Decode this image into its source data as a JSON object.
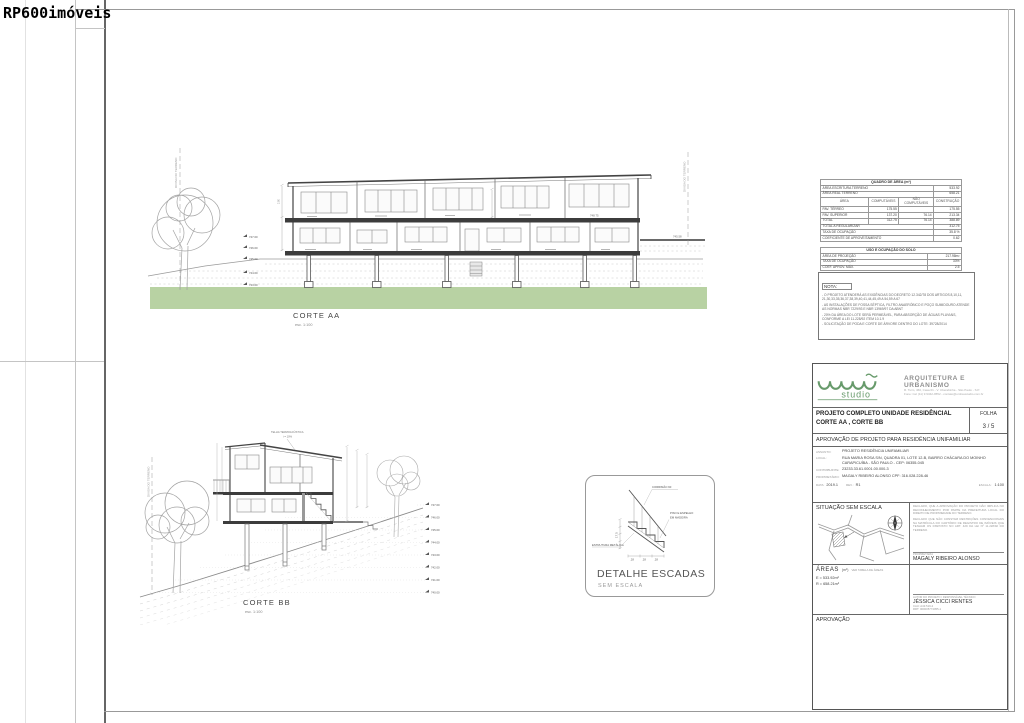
{
  "watermark": "RP600imóveis",
  "colors": {
    "grass": "#b8d2a3",
    "logo_green": "#679a6b",
    "slab_dark": "#3c3c3c"
  },
  "corte_aa": {
    "label": "CORTE AA",
    "scale": "esc. 1:100",
    "divisa": "DIVISA DO TERRENO",
    "levels": [
      "747.00",
      "746.00",
      "745.00",
      "744.00",
      "743.00"
    ],
    "level_upper": "748.75",
    "level_terrace": "745.58",
    "dim_floor": "2.80"
  },
  "corte_bb": {
    "label": "CORTE BB",
    "scale": "esc. 1:100",
    "divisa": "DIVISA DO TERRENO",
    "roof_note_1": "TELHA TERMOACÚSTICA",
    "roof_note_2": "i = 10%",
    "levels": [
      "747.00",
      "746.00",
      "745.00",
      "744.00",
      "743.00",
      "742.00",
      "741.00",
      "740.00"
    ]
  },
  "detalhe": {
    "title": "DETALHE ESCADAS",
    "subtitle": "SEM ESCALA",
    "handrail": "CORRIMÃO 90",
    "wood_1": "PISO E ESPELHO",
    "wood_2": "EM MADEIRA",
    "metal": "ESTRUTURA METÁLICA",
    "riser": "17.5",
    "treads": [
      ".28",
      ".28",
      ".28"
    ]
  },
  "quadro_area": {
    "title": "QUADRO DE ÁREA (m²)",
    "rows_top": [
      [
        "ÁREA ESCRITURA TERRENO",
        "533.92"
      ],
      [
        "ÁREA REAL TERRENO",
        "658.21"
      ]
    ],
    "header": [
      "ÁREA",
      "COMPUTÁVEIS",
      "NÃO COMPUTÁVEIS",
      "CONSTRUÇÃO"
    ],
    "rows": [
      [
        "PAV. TÉRREO",
        "175.55",
        "",
        "175.55"
      ],
      [
        "PAV. SUPERIOR",
        "137.20",
        "76.14",
        "213.34"
      ],
      [
        "TOTAL",
        "312.75",
        "76.14",
        "388.89"
      ]
    ],
    "rows_bottom": [
      [
        "TOTAL A REGULARIZAR",
        "312.75"
      ],
      [
        "TAXA DE OCUPAÇÃO",
        "35.8 %"
      ],
      [
        "COEFICIENTE DE APROVEITAMENTO",
        "0.62"
      ]
    ]
  },
  "uso_solo": {
    "title": "USO E OCUPAÇÃO DO SOLO",
    "rows": [
      [
        "ÁREA DE PROJEÇÃO",
        "217.98m²"
      ],
      [
        "TAXA DE OCUPAÇÃO",
        "33%"
      ],
      [
        "COEF. APROV. MÁX.",
        "2.5"
      ]
    ]
  },
  "nota": {
    "title": "NOTA:",
    "items": [
      "- O PROJETO ATENDERÁ AS EXIGÊNCIAS DO DECRETO 12.342/78 DOS ARTIGOS 8,10,11, 21,30,33,35,36,37,38,39,40,41,44,45,49 A 54,59 A 67",
      "- AS INSTALAÇÕES DE FOSSA SÉPTICA, FILTRO ANAERÓBICO E POÇO SUMIDOURO ATENDE AS NORMAS NBR 7229/93 E NBR 13969/97 DA ABNT",
      "- 20% DA ÁREA DO LOTE SERÁ PERMEÁVEL, PARA ABSORÇÃO DE ÁGUAS PLUVIAIS, CONFORME A LEI 11.228/92 ITEM 10.1.9",
      "- SOLICITAÇÃO DE PODA E CORTE DE ÁRVORE DENTRO DO LOTE: 39728/2014"
    ]
  },
  "titleblock": {
    "logo_name": "studio",
    "arch_title": "ARQUITETURA E URBANISMO",
    "addr1": "R. Tuim, 460, Casa 01 - V. Uberabinha - São Paulo - S.P.",
    "addr2": "Fone: Cel (11) 9 9342-9552 - contato@umbaustudio.com.br",
    "title_line1": "PROJETO COMPLETO UNIDADE RESIDÊNCIAL",
    "title_line2": "CORTE AA , CORTE BB",
    "folha_label": "FOLHA",
    "folha_value": "3 / 5",
    "subtitle": "APROVAÇÃO DE PROJETO PARA RESIDÊNCIA UNIFAMILIAR",
    "fields": [
      {
        "label": "ASSUNTO:",
        "value": "PROJETO RESIDÊNCIA UNIFAMILIAR"
      },
      {
        "label": "LOCAL:",
        "value": "RUA MARIA ROSA S/N, QUADRA 01, LOTE 12-B, BAIRRO CHÁCARA DO MOINHO CARAPICUÍBA - SÃO PAULO - CEP: 06355-045"
      },
      {
        "label": "CONTRIBUINTE:",
        "value": "23233.33.61.0001.00.000-3"
      },
      {
        "label": "PROPRIETÁRIO:",
        "value": "MAGALY RIBEIRO ALONSO   CPF: 316.028.228-46"
      }
    ],
    "data_label": "DATA:",
    "data_value": "2019.1",
    "rev_label": "REV.:",
    "rev_value": "R1",
    "escala_label": "ESCALA:",
    "escala_value": "1:100",
    "situacao_title": "SITUAÇÃO SEM ESCALA",
    "declaracao1": "DECLARO, QUE A APROVAÇÃO DO PROJETO NÃO IMPLICA NO RECONHECIMENTO POR PARTE DA PREFEITURA LOCAL DO DIREITO DE PROPRIEDADE DO TERRENO.",
    "declaracao2": "DECLARO QUE NÃO CONSTAM RESTRIÇÕES CONVENCIONAIS NA MATRÍCULA DO CARTÓRIO DE REGISTRO DE IMÓVEIS QUE TENHAM OS DISPOSTO NO ART. 429 DA LEI Nº 11.228/92 DO TERRENO.",
    "proprietaria_label": "PROPRIETÁRIA",
    "proprietaria_name": "MAGALY RIBEIRO ALONSO",
    "areas_title": "ÁREAS",
    "areas_unit": "(m²)",
    "areas_note": "VER TABELA DE ÁREAS",
    "areas_e": "E = 533.92m²",
    "areas_r": "R = 658.21m²",
    "autor_label": "AUTOR DO PROJETO / RESPONSÁVEL TÉCNICO",
    "autor_name": "JÉSSICA CICCI RENTES",
    "autor_cau": "CAU:  A43.519-2",
    "autor_rrt": "RRT:  000005774055-1",
    "aprovacao_label": "APROVAÇÃO"
  }
}
